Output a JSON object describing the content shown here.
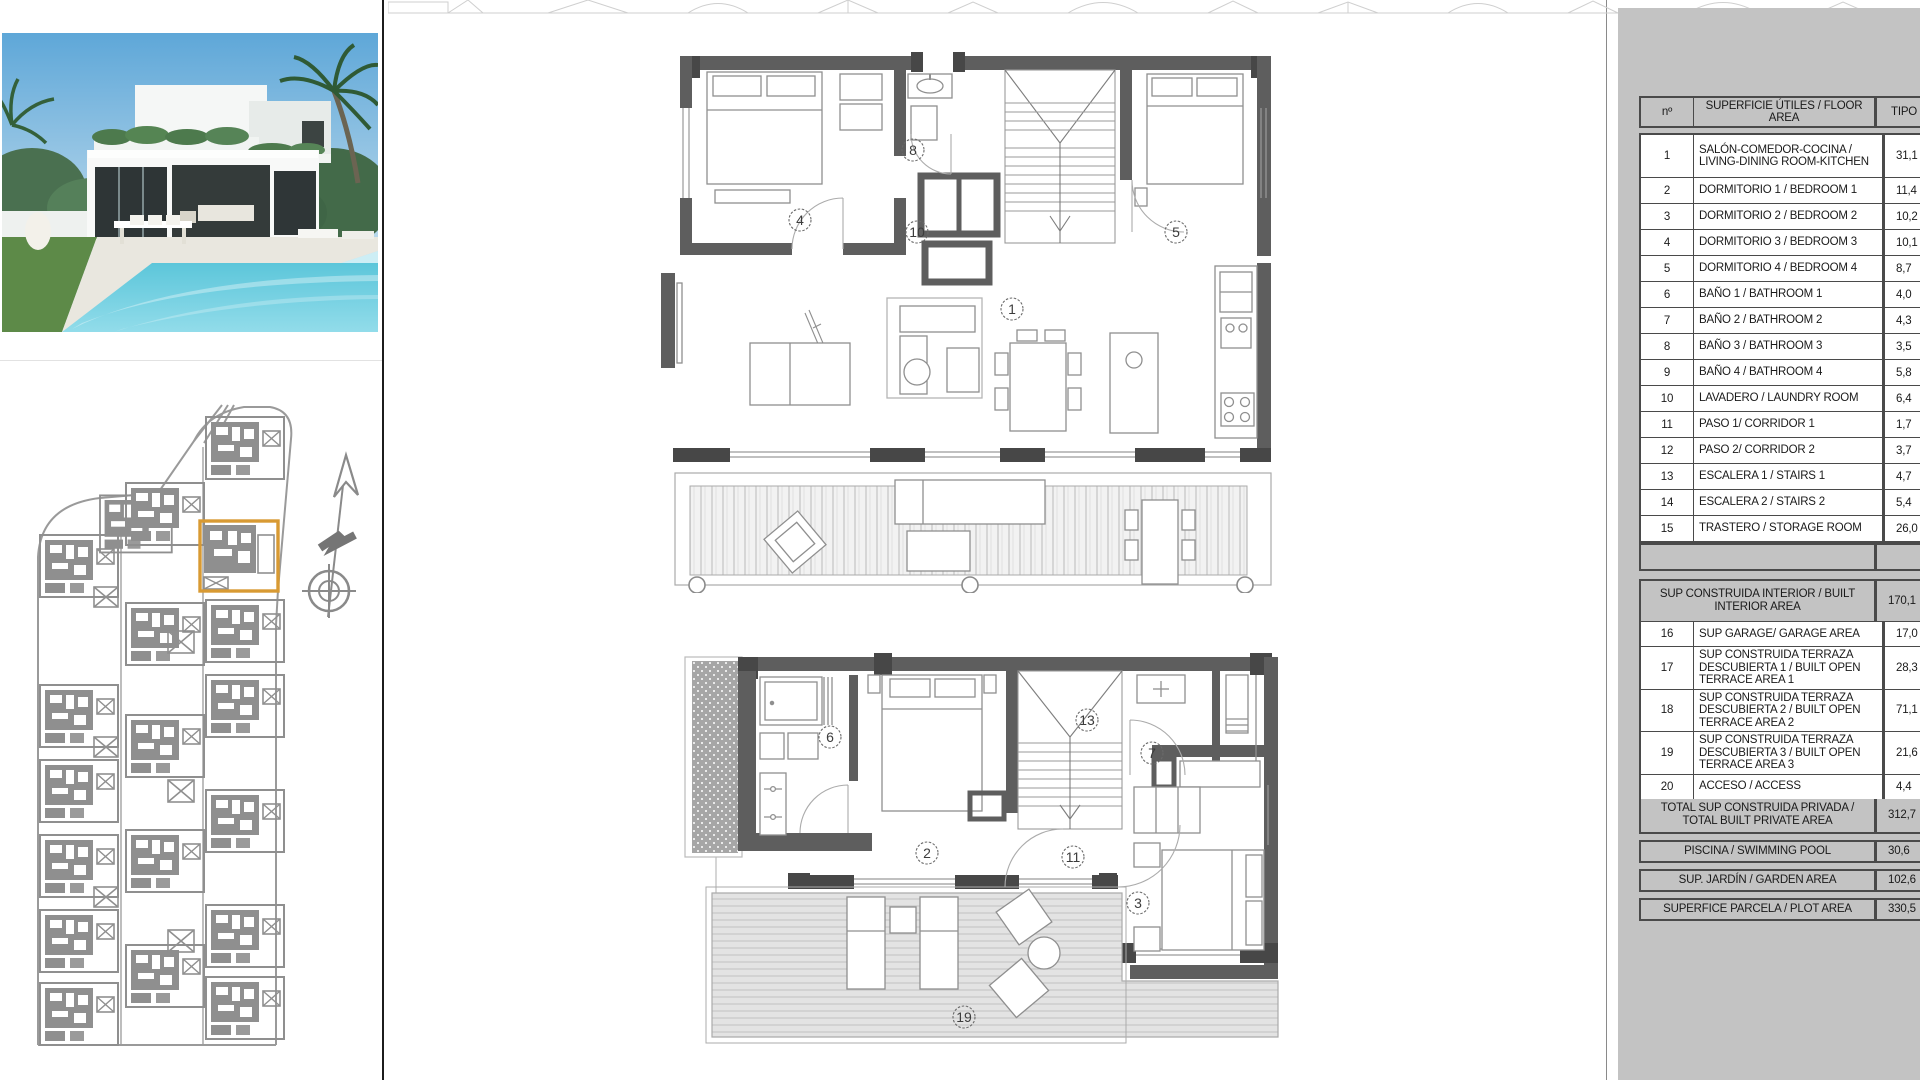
{
  "table": {
    "header": {
      "num": "nº",
      "area": "SUPERFICIE ÚTILES / FLOOR AREA",
      "tipo": "TIPO"
    },
    "rows": [
      {
        "num": "1",
        "label": "SALÓN-COMEDOR-COCINA / LIVING-DINING ROOM-KITCHEN",
        "value": "31,1"
      },
      {
        "num": "2",
        "label": "DORMITORIO 1 / BEDROOM 1",
        "value": "11,4"
      },
      {
        "num": "3",
        "label": "DORMITORIO 2 / BEDROOM 2",
        "value": "10,2"
      },
      {
        "num": "4",
        "label": "DORMITORIO 3 / BEDROOM 3",
        "value": "10,1"
      },
      {
        "num": "5",
        "label": "DORMITORIO 4 / BEDROOM 4",
        "value": "8,7"
      },
      {
        "num": "6",
        "label": "BAÑO 1 / BATHROOM 1",
        "value": "4,0"
      },
      {
        "num": "7",
        "label": "BAÑO 2 / BATHROOM 2",
        "value": "4,3"
      },
      {
        "num": "8",
        "label": "BAÑO 3 / BATHROOM 3",
        "value": "3,5"
      },
      {
        "num": "9",
        "label": "BAÑO 4 / BATHROOM 4",
        "value": "5,8"
      },
      {
        "num": "10",
        "label": "LAVADERO / LAUNDRY ROOM",
        "value": "6,4"
      },
      {
        "num": "11",
        "label": "PASO 1/ CORRIDOR 1",
        "value": "1,7"
      },
      {
        "num": "12",
        "label": "PASO 2/ CORRIDOR 2",
        "value": "3,7"
      },
      {
        "num": "13",
        "label": "ESCALERA 1 / STAIRS 1",
        "value": "4,7"
      },
      {
        "num": "14",
        "label": "ESCALERA 2 / STAIRS 2",
        "value": "5,4"
      },
      {
        "num": "15",
        "label": "TRASTERO / STORAGE ROOM",
        "value": "26,0"
      }
    ],
    "interior_row": {
      "label": "SUP CONSTRUIDA INTERIOR / BUILT INTERIOR AREA",
      "value": "170,1"
    },
    "rows2": [
      {
        "num": "16",
        "label": "SUP GARAGE/ GARAGE AREA",
        "value": "17,0"
      },
      {
        "num": "17",
        "label": "SUP CONSTRUIDA TERRAZA DESCUBIERTA 1 / BUILT OPEN TERRACE AREA 1",
        "value": "28,3"
      },
      {
        "num": "18",
        "label": "SUP CONSTRUIDA TERRAZA DESCUBIERTA 2 / BUILT OPEN TERRACE AREA 2",
        "value": "71,1"
      },
      {
        "num": "19",
        "label": "SUP CONSTRUIDA TERRAZA DESCUBIERTA 3 / BUILT OPEN TERRACE AREA 3",
        "value": "21,6"
      },
      {
        "num": "20",
        "label": "ACCESO / ACCESS",
        "value": "4,4"
      }
    ],
    "total_row": {
      "label": "TOTAL SUP CONSTRUIDA PRIVADA / TOTAL BUILT PRIVATE AREA",
      "value": "312,7"
    },
    "extra_rows": [
      {
        "label": "PISCINA / SWIMMING POOL",
        "value": "30,6"
      },
      {
        "label": "SUP. JARDÍN / GARDEN AREA",
        "value": "102,6"
      },
      {
        "label": "SUPERFICE PARCELA / PLOT AREA",
        "value": "330,5"
      }
    ]
  },
  "plans": {
    "upper_room_labels": [
      "4",
      "8",
      "10",
      "5",
      "1",
      "19"
    ],
    "lower_room_labels": [
      "6",
      "2",
      "13",
      "7",
      "11",
      "3",
      "19"
    ]
  },
  "icons": {
    "north_arrow": "north-arrow-compass"
  },
  "colors": {
    "panel_gray": "#c3c3c3",
    "wall_gray": "#5e5e5e",
    "site_plan_gray": "#8f8f8f",
    "plot_highlight_orange": "#d89a33",
    "table_border": "#4a4a4a"
  }
}
